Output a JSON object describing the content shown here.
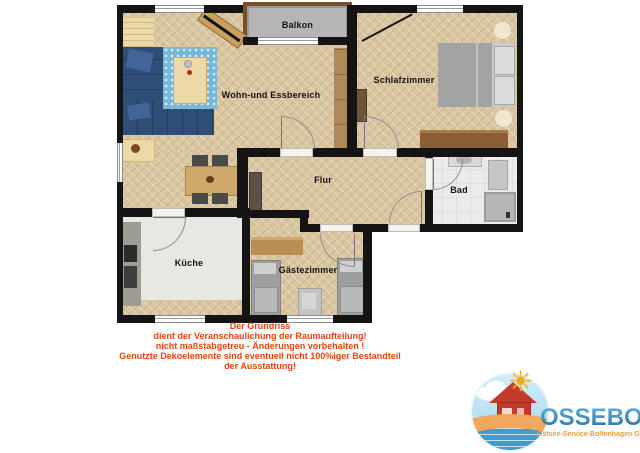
{
  "plan": {
    "rooms": {
      "balkon": "Balkon",
      "wohn": "Wohn-und Essbereich",
      "schlaf": "Schlafzimmer",
      "flur": "Flur",
      "bad": "Bad",
      "kueche": "Küche",
      "gaeste": "Gästezimmer"
    }
  },
  "disclaimer": {
    "lines": [
      "Der Grundriss",
      "dient der Veranschaulichung der Raumaufteilung!",
      "nicht maßstabgetreu - Änderungen vorbehalten !",
      "Genutzte Dekoelemente sind eventuell nicht 100%iger Bestandteil",
      "der Ausstattung!"
    ]
  },
  "logo": {
    "name": "OSSEBO",
    "tagline": "Ostsee-Service-Boltenhagen GmbH",
    "sun_icon": "☀"
  },
  "colors": {
    "wall": "#141414",
    "floor_wood": "#d9c6a1",
    "sofa_blue": "#2e4d77",
    "rug_blue": "#79b6d8",
    "disclaimer_red": "#e8430f",
    "logo_blue": "#1c6ba1",
    "logo_orange": "#ef9d3d"
  }
}
